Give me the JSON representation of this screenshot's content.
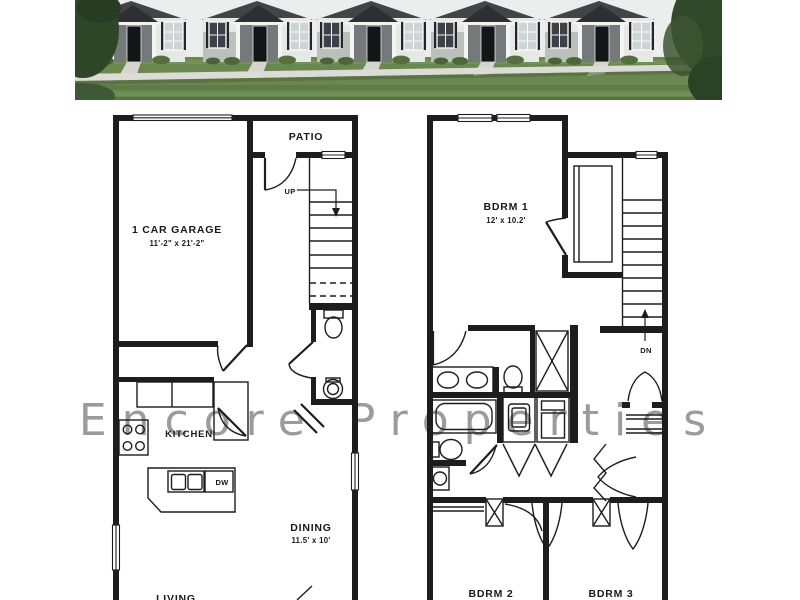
{
  "watermark": {
    "text": "Encore Properties",
    "color": "#9b9b9b"
  },
  "photo": {
    "name": "townhouse-row-photo",
    "units": 5,
    "colors": {
      "sky": "#eceded",
      "roof": "#434446",
      "porch_roof": "#2e2f31",
      "siding": "#e7e7e5",
      "lawn": "#6a8750",
      "sidewalk": "#dcdbd5",
      "door": "#131517",
      "tree": "#2f4527"
    }
  },
  "floor1": {
    "patio_label": "PATIO",
    "garage_label": "1 CAR GARAGE",
    "garage_dims": "11'-2\" x 21'-2\"",
    "up_label": "UP",
    "kitchen_label": "KITCHEN",
    "dishwasher_label": "DW",
    "dining_label": "DINING",
    "dining_dims": "11.5' x 10'",
    "living_label": "LIVING"
  },
  "floor2": {
    "bdrm1_label": "BDRM 1",
    "bdrm1_dims": "12' x 10.2'",
    "dn_label": "DN",
    "bdrm2_label": "BDRM 2",
    "bdrm3_label": "BDRM 3"
  },
  "colors": {
    "wall": "#1d1d1e",
    "background": "#ffffff"
  }
}
